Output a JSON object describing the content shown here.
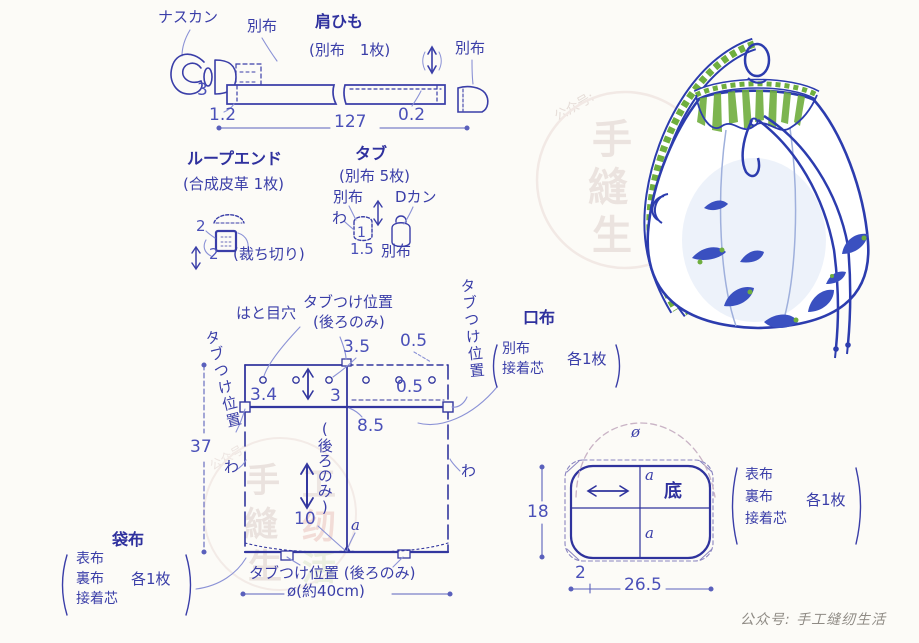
{
  "colors": {
    "ink_blue": "#3a3ea8",
    "title_blue": "#2f319e",
    "dim_blue": "#4a50b8",
    "leader_blue": "#8b92d6",
    "bag_outline_blue": "#2c3cae",
    "bag_green": "#6fae3e",
    "watermark_gray": "#ebe3df",
    "watermark_pink": "#f3d9d3",
    "paper": "#fcfbf7"
  },
  "strap": {
    "hook_label": "ナスカン",
    "fabric_label_left": "別布",
    "title": "肩ひも",
    "count": "(別布　1枚)",
    "fabric_label_right": "別布",
    "dim_height": "3",
    "dim_fold": "1.2",
    "dim_stitch": "0.2",
    "dim_length": "127"
  },
  "loop_end": {
    "title": "ループエンド",
    "count": "(合成皮革 1枚)",
    "dim_w": "2",
    "dim_h": "2",
    "note": "(裁ち切り)"
  },
  "tab": {
    "title": "タブ",
    "count": "(別布 5枚)",
    "fabric": "別布",
    "dring": "Dカン",
    "fold": "わ",
    "dim_1": "1",
    "dim_15": "1.5",
    "fabric2": "別布"
  },
  "body": {
    "label_tab_top_1": "タブつけ位置",
    "label_tab_top_2": "(後ろのみ)",
    "label_eyelet": "はと目穴",
    "label_tab_left": "タブつけ位置",
    "label_tab_right": "タブつけ位置",
    "dim_35": "3.5",
    "dim_05_top": "0.5",
    "dim_34": "3.4",
    "dim_3": "3",
    "dim_05_mid": "0.5",
    "dim_85": "8.5",
    "dim_37": "37",
    "fold_left": "わ",
    "fold_right": "わ",
    "label_back_only": "(後ろのみ)",
    "dim_10": "10",
    "point_a": "a",
    "label_tab_bottom": "タブつけ位置 (後ろのみ)",
    "dim_diameter": "ø(約40cm)"
  },
  "fukuro": {
    "title": "袋布",
    "line1": "表布",
    "line2": "裏布",
    "line3": "接着芯",
    "count": "各1枚"
  },
  "kuchi": {
    "title": "口布",
    "line1": "別布",
    "line2": "接着芯",
    "count": "各1枚"
  },
  "bottom": {
    "title": "底",
    "dim_diameter": "ø",
    "point_a_top": "a",
    "point_a_bottom": "a",
    "dim_18": "18",
    "dim_2": "2",
    "dim_265": "26.5",
    "note_line1": "表布",
    "note_line2": "裏布",
    "note_line3": "接着芯",
    "note_count": "各1枚"
  },
  "watermark": {
    "credit": "公众号: 手工缝纫生活",
    "diag_label": "公众号:",
    "seal": [
      "手",
      "工",
      "縫",
      "纫",
      "生",
      "活"
    ]
  }
}
